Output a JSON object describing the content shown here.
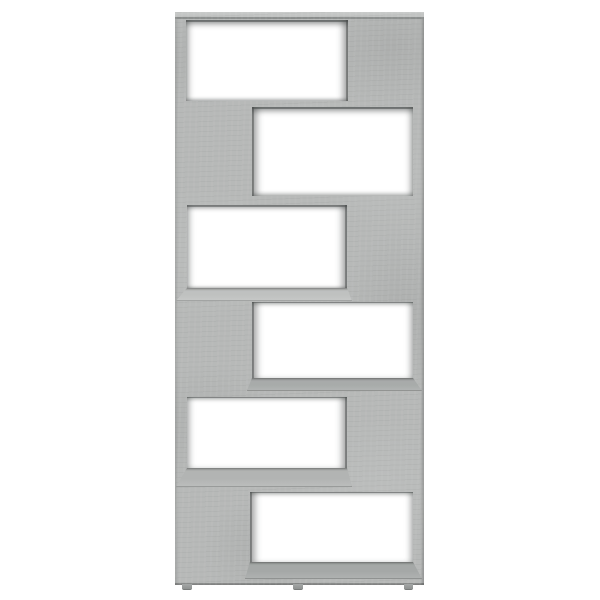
{
  "scene": {
    "type": "product-photo",
    "subject": "zigzag bookcase room divider with six staggered open compartments",
    "finish_name": "concrete gray",
    "background_color": "#ffffff",
    "text_content": "none"
  },
  "palette": {
    "panel_base": "#b7b9b8",
    "panel_top_face": "#c9cbca",
    "edge_shadow": "#8d908f",
    "opening_fill": "#ffffff",
    "shelf_face_light": "#bfc1c0",
    "shelf_face_mid": "#b2b4b3",
    "shelf_face_dark": "#a8abaa",
    "shelf_face_deep": "#a5a8a7",
    "foot_color": "#9b9e9d"
  },
  "bookcase": {
    "unit": {
      "x": 175,
      "y": 12,
      "w": 249,
      "h": 573
    },
    "top_face_height": 7,
    "compartments": [
      {
        "row": 1,
        "open_side": "left",
        "opening": {
          "x": 186,
          "y": 20,
          "w": 162,
          "h": 81
        },
        "shelf_face": null
      },
      {
        "row": 2,
        "open_side": "right",
        "opening": {
          "x": 252,
          "y": 107,
          "w": 161,
          "h": 89
        },
        "shelf_face": null
      },
      {
        "row": 3,
        "open_side": "left",
        "opening": {
          "x": 187,
          "y": 205,
          "w": 160,
          "h": 83
        },
        "shelf_face": {
          "h": 13,
          "color_key": "shelf_face_light"
        }
      },
      {
        "row": 4,
        "open_side": "right",
        "opening": {
          "x": 252,
          "y": 302,
          "w": 161,
          "h": 76
        },
        "shelf_face": {
          "h": 13,
          "color_key": "shelf_face_dark"
        }
      },
      {
        "row": 5,
        "open_side": "left",
        "opening": {
          "x": 187,
          "y": 397,
          "w": 160,
          "h": 71
        },
        "shelf_face": {
          "h": 19,
          "color_key": "shelf_face_mid"
        }
      },
      {
        "row": 6,
        "open_side": "right",
        "opening": {
          "x": 250,
          "y": 492,
          "w": 163,
          "h": 70
        },
        "shelf_face": {
          "h": 17,
          "color_key": "shelf_face_deep"
        }
      }
    ],
    "feet": [
      {
        "x": 182,
        "y": 584,
        "w": 10,
        "h": 5
      },
      {
        "x": 293,
        "y": 584,
        "w": 10,
        "h": 5
      },
      {
        "x": 404,
        "y": 584,
        "w": 9,
        "h": 5
      }
    ]
  }
}
